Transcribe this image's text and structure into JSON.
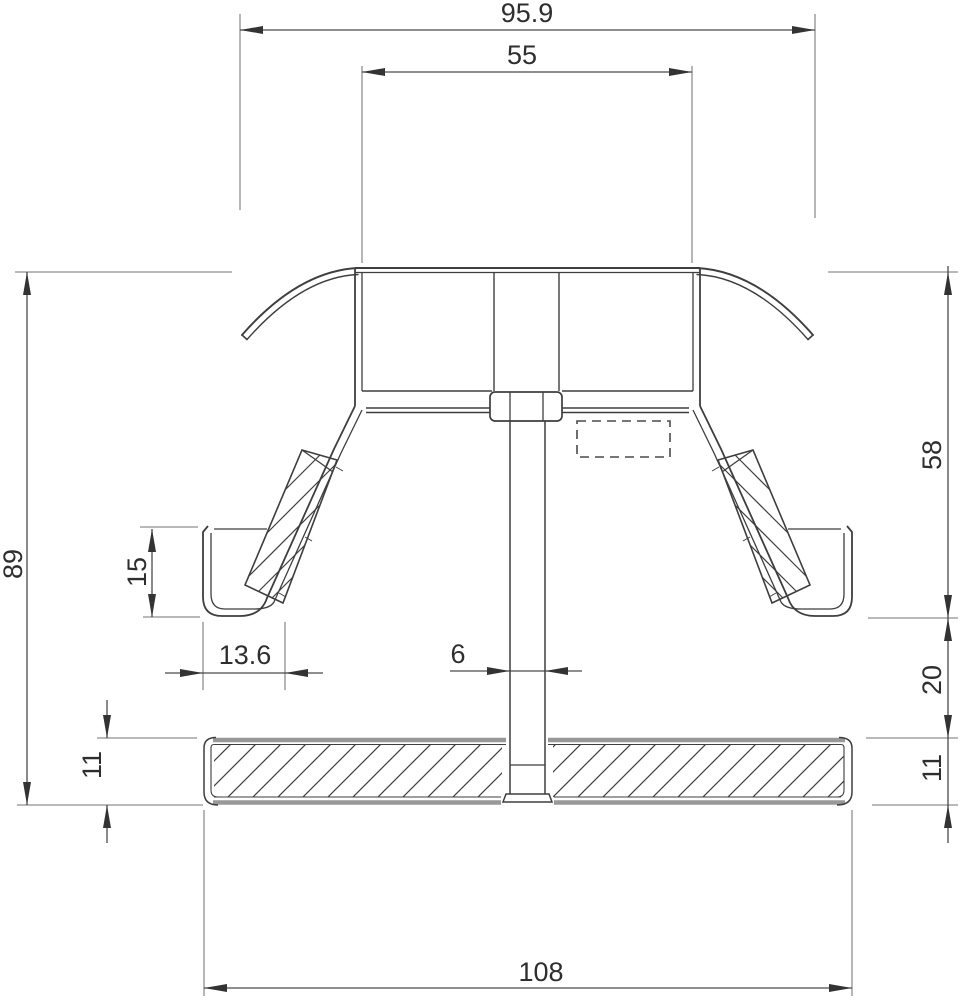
{
  "drawing": {
    "type": "technical-cross-section",
    "dimensions": {
      "span_overall": "95.9",
      "span_inner": "55",
      "height_overall": "89",
      "height_upper": "58",
      "height_gap": "20",
      "plate_thickness_right": "11",
      "foot_height": "15",
      "foot_width": "13.6",
      "bolt_width": "6",
      "plate_width": "108",
      "plate_thickness_left": "11"
    },
    "colors": {
      "structure_line": "#3e3e3e",
      "dimension_line": "#4a4a4a",
      "extension_line": "#8f8f8f",
      "text": "#2e2e2e",
      "thick_edge": "#989898",
      "background": "#ffffff"
    }
  }
}
